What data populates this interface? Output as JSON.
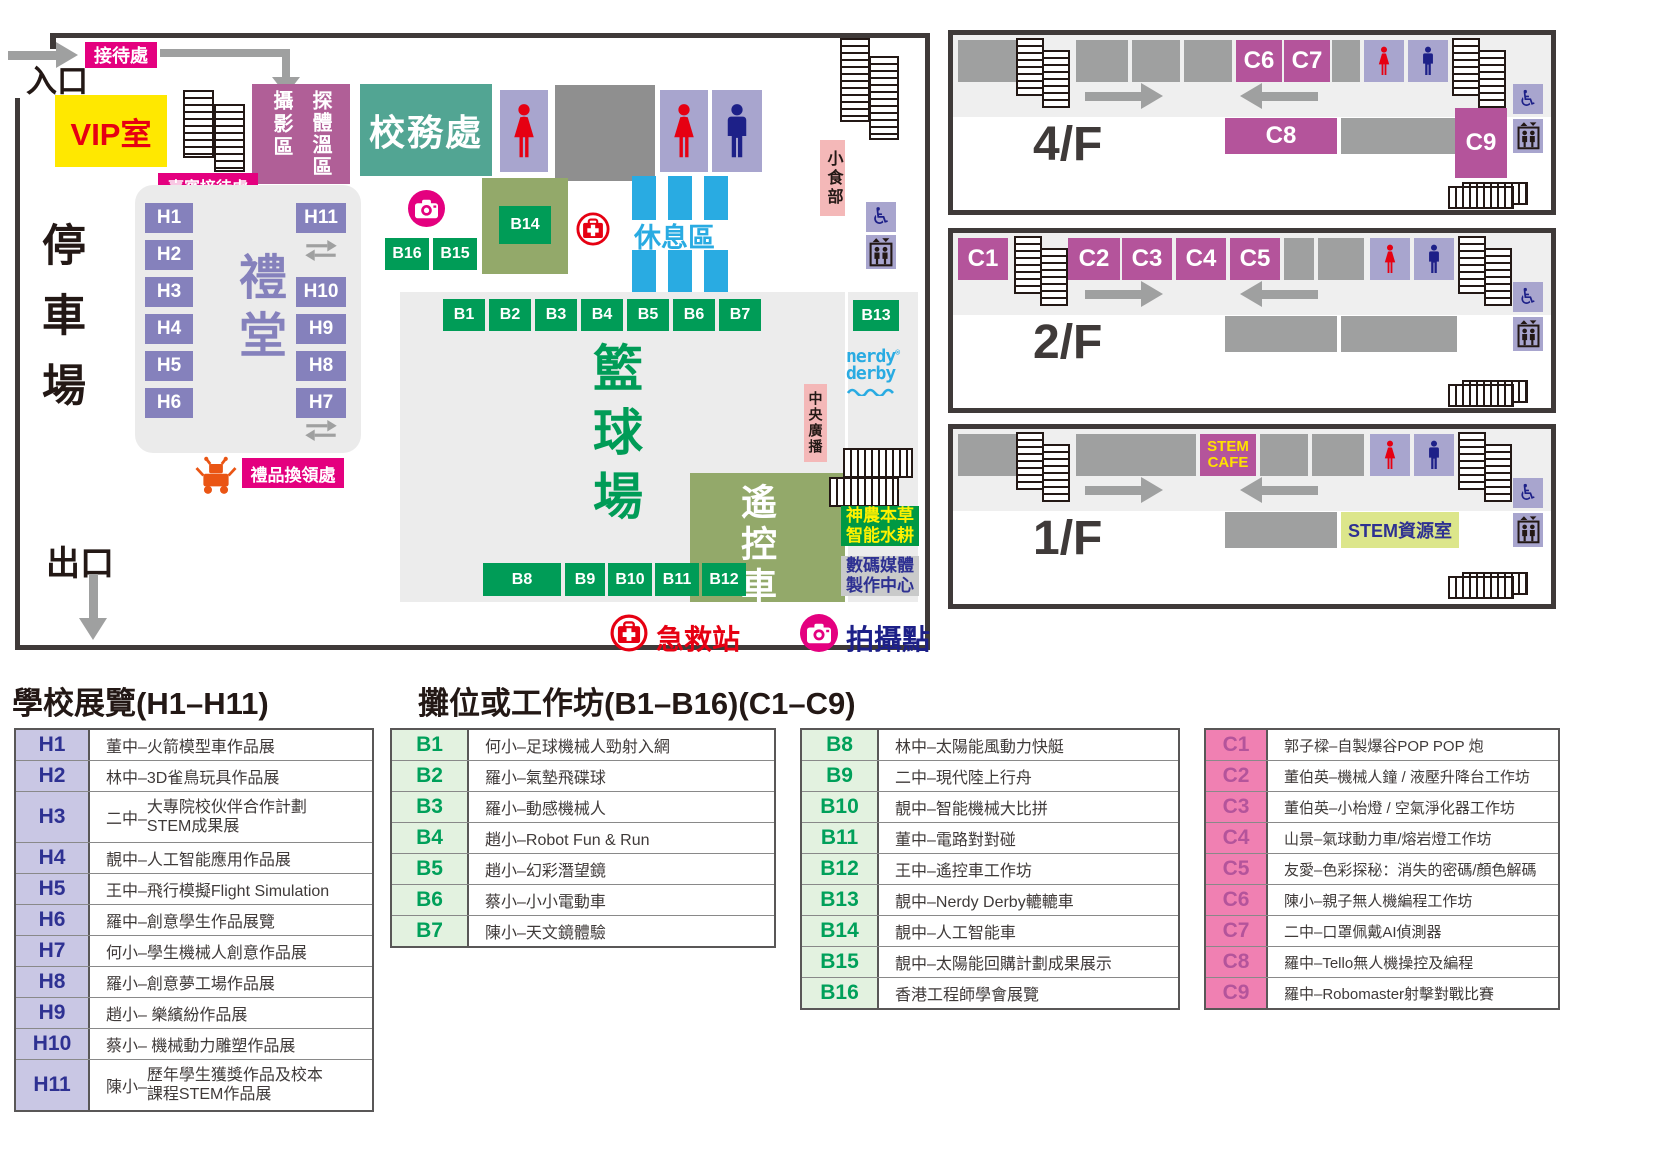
{
  "map": {
    "entrance": "入口",
    "exit": "出口",
    "reception": "接待處",
    "guest_reception": "嘉賓接待處",
    "vip_room": "VIP室",
    "photo_area": "攝影區",
    "temperature_check": "探體溫區",
    "school_office": "校務處",
    "hall": "禮堂",
    "parking": "停車場",
    "gift_redemption": "禮品換領處",
    "snack_bar": "小食部",
    "rest_area": "休息區",
    "basketball_court": "籃球場",
    "rc_car_zone": "遙控車",
    "central_broadcast": "中央廣播",
    "hydroponics_line1": "神農本草",
    "hydroponics_line2": "智能水耕",
    "digital_media_line1": "數碼媒體",
    "digital_media_line2": "製作中心",
    "nerdy_derby_line1": "nerdy",
    "nerdy_derby_line2": "derby",
    "nerdy_derby_reg": "®",
    "hall_booths_left": [
      "H1",
      "H2",
      "H3",
      "H4",
      "H5",
      "H6"
    ],
    "hall_booths_right": [
      "H11",
      "H10",
      "H9",
      "H8",
      "H7"
    ],
    "court_booths_top": [
      "B1",
      "B2",
      "B3",
      "B4",
      "B5",
      "B6",
      "B7"
    ],
    "court_booths_bottom": [
      "B8",
      "B9",
      "B10",
      "B11",
      "B12"
    ],
    "booth_b13": "B13",
    "booth_b14": "B14",
    "booth_b15": "B15",
    "booth_b16": "B16",
    "first_aid_station": "急救站",
    "photo_point": "拍攝點"
  },
  "floors": {
    "f4": {
      "label": "4/F",
      "c6": "C6",
      "c7": "C7",
      "c8": "C8",
      "c9": "C9"
    },
    "f2": {
      "label": "2/F",
      "c1": "C1",
      "c2": "C2",
      "c3": "C3",
      "c4": "C4",
      "c5": "C5"
    },
    "f1": {
      "label": "1/F",
      "stem_cafe_line1": "STEM",
      "stem_cafe_line2": "CAFE",
      "stem_room": "STEM資源室"
    }
  },
  "icons": {
    "wheelchair_glyph": "♿"
  },
  "colors": {
    "accent_magenta": "#e4007f",
    "booth_green": "#009c57",
    "booth_purple": "#8581bc",
    "booth_plum": "#b4549b",
    "office_teal": "#52a593",
    "rest_blue": "#29abe2",
    "navy": "#1d2088",
    "red": "#e60012",
    "vip_yellow": "#ffe800",
    "rc_olive": "#93a96a"
  },
  "legend": {
    "schools_title": "學校展覽(H1–H11)",
    "booths_title": "攤位或工作坊(B1–B16)(C1–C9)",
    "h_rows": [
      {
        "code": "H1",
        "desc": "董中–火箭模型車作品展"
      },
      {
        "code": "H2",
        "desc": "林中–3D雀鳥玩具作品展"
      },
      {
        "code": "H3",
        "prefix": "二中–",
        "line1": "大專院校伙伴合作計劃",
        "line2": "STEM成果展"
      },
      {
        "code": "H4",
        "desc": "靚中–人工智能應用作品展"
      },
      {
        "code": "H5",
        "desc": "王中–飛行模擬Flight Simulation"
      },
      {
        "code": "H6",
        "desc": "羅中–創意學生作品展覽"
      },
      {
        "code": "H7",
        "desc": "何小–學生機械人創意作品展"
      },
      {
        "code": "H8",
        "desc": "羅小–創意夢工場作品展"
      },
      {
        "code": "H9",
        "desc": "趙小– 樂繽紛作品展"
      },
      {
        "code": "H10",
        "desc": "蔡小– 機械動力雕塑作品展"
      },
      {
        "code": "H11",
        "prefix": "陳小–",
        "line1": "歷年學生獲獎作品及校本",
        "line2": "課程STEM作品展"
      }
    ],
    "b_rows_1": [
      {
        "code": "B1",
        "desc": "何小–足球機械人勁射入網"
      },
      {
        "code": "B2",
        "desc": "羅小–氣墊飛碟球"
      },
      {
        "code": "B3",
        "desc": "羅小–動感機械人"
      },
      {
        "code": "B4",
        "desc": "趙小–Robot Fun & Run"
      },
      {
        "code": "B5",
        "desc": "趙小–幻彩潛望鏡"
      },
      {
        "code": "B6",
        "desc": "蔡小–小小電動車"
      },
      {
        "code": "B7",
        "desc": "陳小–天文鏡體驗"
      }
    ],
    "b_rows_2": [
      {
        "code": "B8",
        "desc": "林中–太陽能風動力快艇"
      },
      {
        "code": "B9",
        "desc": "二中–現代陸上行舟"
      },
      {
        "code": "B10",
        "desc": "靚中–智能機械大比拼"
      },
      {
        "code": "B11",
        "desc": "董中–電路對對碰"
      },
      {
        "code": "B12",
        "desc": "王中–遙控車工作坊"
      },
      {
        "code": "B13",
        "desc": "靚中–Nerdy Derby轆轆車"
      },
      {
        "code": "B14",
        "desc": "靚中–人工智能車"
      },
      {
        "code": "B15",
        "desc": "靚中–太陽能回購計劃成果展示"
      },
      {
        "code": "B16",
        "desc": "香港工程師學會展覽"
      }
    ],
    "c_rows": [
      {
        "code": "C1",
        "desc": "郭子樑–自製爆谷POP POP 炮"
      },
      {
        "code": "C2",
        "desc": "董伯英–機械人鐘 / 液壓升降台工作坊"
      },
      {
        "code": "C3",
        "desc": "董伯英–小枱燈 / 空氣淨化器工作坊"
      },
      {
        "code": "C4",
        "desc": "山景–氣球動力車/熔岩燈工作坊"
      },
      {
        "code": "C5",
        "desc": "友愛–色彩探秘：消失的密碼/顏色解碼"
      },
      {
        "code": "C6",
        "desc": "陳小–親子無人機編程工作坊"
      },
      {
        "code": "C7",
        "desc": "二中–口罩佩戴AI偵測器"
      },
      {
        "code": "C8",
        "desc": "羅中–Tello無人機操控及編程"
      },
      {
        "code": "C9",
        "desc": "羅中–Robomaster射擊對戰比賽"
      }
    ]
  }
}
